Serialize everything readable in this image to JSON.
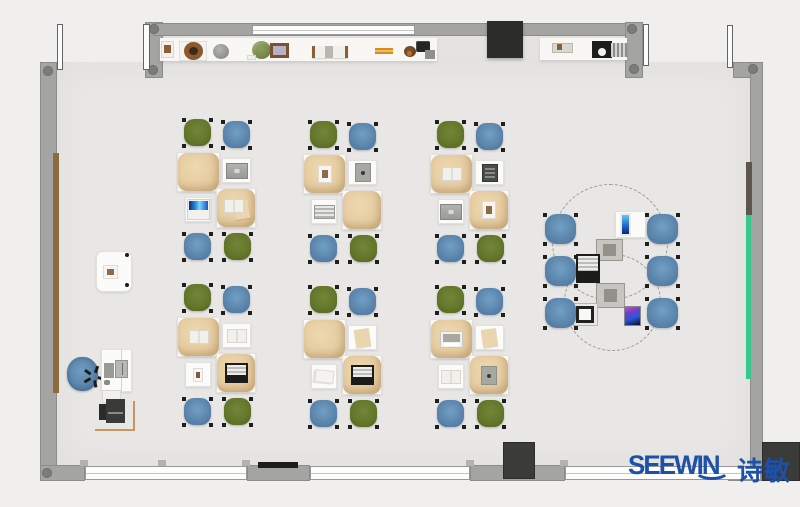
{
  "logo": {
    "brand": "SEEWIN",
    "chinese": "诗敏"
  },
  "palette": {
    "outside": "#f0efee",
    "floor": "#e8e7e5",
    "wall": "#a4a4a2",
    "chair_green": "#64772a",
    "chair_blue": "#5d86ad",
    "cushion_tan": "#e5cba0",
    "desk_white": "#fbfbf9",
    "accent_green_strip": "#36c98b",
    "wood_brown": "#8d6b40",
    "orange_line": "#c8965a",
    "logo_blue": "#1d50a8",
    "tv_black": "#2c2c2a"
  },
  "room": {
    "floor": {
      "x": 56,
      "y": 62,
      "w": 694,
      "h": 404
    },
    "floor_upper": {
      "x": 163,
      "y": 34,
      "w": 474,
      "h": 28
    },
    "walls": [
      {
        "name": "wall-left",
        "x": 40,
        "y": 62,
        "w": 17,
        "h": 405
      },
      {
        "name": "wall-top-stub-left",
        "x": 145,
        "y": 22,
        "w": 18,
        "h": 56
      },
      {
        "name": "wall-top",
        "x": 153,
        "y": 23,
        "w": 484,
        "h": 13
      },
      {
        "name": "wall-top-stub-right",
        "x": 625,
        "y": 22,
        "w": 18,
        "h": 56
      },
      {
        "name": "wall-corner-top-right",
        "x": 733,
        "y": 62,
        "w": 30,
        "h": 16
      },
      {
        "name": "wall-right",
        "x": 750,
        "y": 62,
        "w": 13,
        "h": 405
      },
      {
        "name": "wall-bottom-corner-left",
        "x": 40,
        "y": 465,
        "w": 45,
        "h": 16
      },
      {
        "name": "wall-bottom-seg-1",
        "x": 247,
        "y": 465,
        "w": 63,
        "h": 16
      },
      {
        "name": "wall-bottom-seg-2",
        "x": 470,
        "y": 465,
        "w": 95,
        "h": 16
      },
      {
        "name": "wall-bottom-seg-3",
        "x": 728,
        "y": 466,
        "w": 34,
        "h": 15
      }
    ],
    "corner_dots": [
      {
        "x": 43,
        "y": 66
      },
      {
        "x": 149,
        "y": 24
      },
      {
        "x": 148,
        "y": 65
      },
      {
        "x": 627,
        "y": 24
      },
      {
        "x": 629,
        "y": 64
      },
      {
        "x": 748,
        "y": 64
      },
      {
        "x": 42,
        "y": 468
      }
    ],
    "windows": [
      {
        "name": "window-top",
        "x": 252,
        "y": 25,
        "w": 163,
        "h": 10
      },
      {
        "name": "window-bottom-1",
        "x": 85,
        "y": 466,
        "w": 162,
        "h": 14
      },
      {
        "name": "window-bottom-2",
        "x": 310,
        "y": 466,
        "w": 160,
        "h": 14
      },
      {
        "name": "window-bottom-3",
        "x": 565,
        "y": 466,
        "w": 196,
        "h": 14
      }
    ],
    "window_tabs": [
      {
        "x": 80,
        "y": 460
      },
      {
        "x": 158,
        "y": 460
      },
      {
        "x": 242,
        "y": 460
      },
      {
        "x": 466,
        "y": 460
      },
      {
        "x": 560,
        "y": 460
      }
    ],
    "doors": [
      {
        "name": "door-leaf-top-left-1",
        "x": 57,
        "y": 24,
        "w": 6,
        "h": 46
      },
      {
        "name": "door-leaf-top-left-2",
        "x": 143,
        "y": 24,
        "w": 7,
        "h": 46
      },
      {
        "name": "door-leaf-top-right-1",
        "x": 643,
        "y": 24,
        "w": 6,
        "h": 42
      },
      {
        "name": "door-leaf-top-right-2",
        "x": 727,
        "y": 25,
        "w": 6,
        "h": 43
      }
    ],
    "wall_strips": [
      {
        "name": "wood-panel-left",
        "cls": "it-woodstrip",
        "x": 53,
        "y": 153,
        "w": 6,
        "h": 240
      },
      {
        "name": "dark-panel-right",
        "cls": "it-darkstrip",
        "x": 746,
        "y": 162,
        "w": 6,
        "h": 53
      },
      {
        "name": "green-board-right",
        "cls": "it-greenstrip",
        "x": 746,
        "y": 215,
        "w": 5,
        "h": 164
      }
    ],
    "counters": [
      {
        "name": "top-counter-left",
        "x": 160,
        "y": 38,
        "w": 277,
        "h": 23
      },
      {
        "name": "top-counter-right",
        "x": 540,
        "y": 38,
        "w": 87,
        "h": 22
      }
    ],
    "counter_items": [
      {
        "name": "white-box",
        "cls": "it-whitebox",
        "x": 161,
        "y": 41,
        "w": 13,
        "h": 17
      },
      {
        "name": "brown-ornament",
        "cls": "it-brownbit",
        "x": 164,
        "y": 45,
        "w": 7,
        "h": 8
      },
      {
        "name": "plate",
        "cls": "it-plate",
        "x": 179,
        "y": 41,
        "w": 28,
        "h": 20
      },
      {
        "name": "wreath-bowl",
        "cls": "it-wreath",
        "x": 184,
        "y": 42,
        "w": 19,
        "h": 18
      },
      {
        "name": "gray-sphere",
        "cls": "it-sphere",
        "x": 213,
        "y": 44,
        "w": 16,
        "h": 15
      },
      {
        "name": "plant-pot",
        "cls": "it-plant",
        "x": 252,
        "y": 41,
        "w": 19,
        "h": 18
      },
      {
        "name": "paper-scraps",
        "cls": "it-whitebox",
        "x": 247,
        "y": 55,
        "w": 9,
        "h": 5
      },
      {
        "name": "photo-frame",
        "cls": "it-frame",
        "x": 270,
        "y": 43,
        "w": 19,
        "h": 15
      },
      {
        "name": "bookends-row",
        "cls": "it-bookrow",
        "x": 312,
        "y": 46,
        "w": 36,
        "h": 12
      },
      {
        "name": "orange-sticks",
        "cls": "it-sticks",
        "x": 375,
        "y": 48,
        "w": 18,
        "h": 6
      },
      {
        "name": "brown-round-gadget",
        "cls": "it-brownround",
        "x": 404,
        "y": 46,
        "w": 12,
        "h": 11
      },
      {
        "name": "black-gear-gadget",
        "cls": "it-gear",
        "x": 416,
        "y": 41,
        "w": 14,
        "h": 11
      },
      {
        "name": "gray-gadget",
        "cls": "it-graybit",
        "x": 425,
        "y": 50,
        "w": 10,
        "h": 9
      },
      {
        "name": "orange-dot-gadget",
        "cls": "it-orangedot",
        "x": 407,
        "y": 51,
        "w": 5,
        "h": 5
      },
      {
        "name": "gray-box",
        "cls": "it-graybox",
        "x": 552,
        "y": 43,
        "w": 21,
        "h": 10
      },
      {
        "name": "brown-dot",
        "cls": "it-brownbit",
        "x": 557,
        "y": 44,
        "w": 5,
        "h": 6
      },
      {
        "name": "black-camera",
        "cls": "it-camera",
        "x": 592,
        "y": 41,
        "w": 20,
        "h": 17
      },
      {
        "name": "striped-ramp",
        "cls": "it-ramp",
        "x": 611,
        "y": 43,
        "w": 16,
        "h": 14
      }
    ],
    "fixtures": [
      {
        "name": "tv-panel",
        "cls": "it-tv",
        "x": 487,
        "y": 21,
        "w": 36,
        "h": 37
      },
      {
        "name": "vent-bar",
        "cls": "it-blackbar",
        "x": 258,
        "y": 462,
        "w": 40,
        "h": 6
      },
      {
        "name": "dark-column-bottom-center",
        "cls": "it-darkblock",
        "x": 503,
        "y": 442,
        "w": 32,
        "h": 37
      },
      {
        "name": "dark-column-bottom-right",
        "cls": "it-darkblock",
        "x": 762,
        "y": 442,
        "w": 38,
        "h": 39
      }
    ]
  },
  "furniture": {
    "cluster_template": {
      "chairs": [
        {
          "pos": "tl",
          "dx": 5,
          "dy": 0,
          "w": 31,
          "h": 30,
          "color": "green"
        },
        {
          "pos": "tr",
          "dx": 44,
          "dy": 2,
          "w": 31,
          "h": 30,
          "color": "blue"
        },
        {
          "pos": "bl",
          "dx": 5,
          "dy": 114,
          "w": 31,
          "h": 30,
          "color": "blue"
        },
        {
          "pos": "br",
          "dx": 45,
          "dy": 114,
          "w": 31,
          "h": 30,
          "color": "green"
        }
      ],
      "desks": [
        {
          "pos": "tl",
          "dx": 0,
          "dy": 34,
          "w": 43,
          "h": 40,
          "tan": true
        },
        {
          "pos": "tr",
          "dx": 45,
          "dy": 40,
          "w": 29,
          "h": 25,
          "tan": false
        },
        {
          "pos": "bl",
          "dx": 8,
          "dy": 79,
          "w": 26,
          "h": 25,
          "tan": false
        },
        {
          "pos": "br",
          "dx": 39,
          "dy": 70,
          "w": 40,
          "h": 40,
          "tan": true
        }
      ]
    },
    "clusters": [
      {
        "id": "A",
        "x": 177,
        "y": 118,
        "items": {
          "tl": "none",
          "tr": "laptop-gray",
          "bl": "laptop-blue",
          "br": "book-paper"
        }
      },
      {
        "id": "B",
        "x": 303,
        "y": 120,
        "items": {
          "tl": "paper-pic",
          "tr": "tablet-gray",
          "bl": "book-lined",
          "br": "none"
        }
      },
      {
        "id": "C",
        "x": 430,
        "y": 120,
        "items": {
          "tl": "book-open",
          "tr": "tablet-dark",
          "bl": "laptop-gray",
          "br": "paper-pic"
        }
      },
      {
        "id": "D",
        "x": 177,
        "y": 283,
        "items": {
          "tl": "book-open",
          "tr": "book-open",
          "bl": "pic-brown",
          "br": "laptop-black"
        }
      },
      {
        "id": "E",
        "x": 303,
        "y": 285,
        "items": {
          "tl": "none",
          "tr": "paper-tan",
          "bl": "papers",
          "br": "laptop-black"
        }
      },
      {
        "id": "F",
        "x": 430,
        "y": 285,
        "items": {
          "tl": "monitor-white",
          "tr": "paper-tan",
          "bl": "book-open",
          "br": "tablet-gray"
        }
      }
    ],
    "round_group": {
      "dashed_circles": [
        {
          "x": 552,
          "y": 184,
          "w": 116,
          "h": 116
        },
        {
          "x": 564,
          "y": 254,
          "w": 97,
          "h": 97
        }
      ],
      "chairs": [
        {
          "x": 543,
          "y": 213
        },
        {
          "x": 645,
          "y": 213
        },
        {
          "x": 543,
          "y": 255
        },
        {
          "x": 645,
          "y": 255
        },
        {
          "x": 543,
          "y": 297
        },
        {
          "x": 645,
          "y": 297
        }
      ],
      "chair_size": {
        "w": 35,
        "h": 33
      },
      "devices": [
        {
          "name": "side-table",
          "cls": "desk",
          "x": 615,
          "y": 211,
          "w": 31,
          "h": 27
        },
        {
          "name": "tablet-blue-screen",
          "cls": "it-tablet-blue",
          "x": 620,
          "y": 213,
          "w": 11,
          "h": 23
        },
        {
          "name": "tablet-gray-top",
          "cls": "it-tablet-gray2",
          "x": 596,
          "y": 239,
          "w": 27,
          "h": 22
        },
        {
          "name": "laptop-black",
          "cls": "it-laptop-black",
          "x": 576,
          "y": 254,
          "w": 24,
          "h": 29
        },
        {
          "name": "tablet-gray-bottom",
          "cls": "it-tablet-gray2",
          "x": 596,
          "y": 283,
          "w": 29,
          "h": 25
        },
        {
          "name": "laptop-white",
          "cls": "it-laptop-white",
          "x": 573,
          "y": 303,
          "w": 25,
          "h": 23
        },
        {
          "name": "smartphone",
          "cls": "it-phone",
          "x": 624,
          "y": 306,
          "w": 17,
          "h": 20
        }
      ]
    },
    "teacher_zone": {
      "props": [
        {
          "name": "side-table",
          "kind": "rect",
          "cls": "desk rounded",
          "x": 96,
          "y": 251,
          "w": 36,
          "h": 41
        },
        {
          "name": "side-table-photo",
          "kind": "rect",
          "cls": "itm it-paper-pic",
          "x": 103,
          "y": 265,
          "w": 15,
          "h": 14
        },
        {
          "name": "side-table-leg-1",
          "kind": "rect",
          "cls": "itm it-dotsm",
          "x": 125,
          "y": 253,
          "w": 4,
          "h": 4
        },
        {
          "name": "side-table-leg-2",
          "kind": "rect",
          "cls": "itm it-dotsm",
          "x": 125,
          "y": 283,
          "w": 4,
          "h": 4
        },
        {
          "name": "teacher-chair",
          "kind": "officechair",
          "x": 64,
          "y": 355,
          "w": 37,
          "h": 39
        },
        {
          "name": "teacher-desk",
          "kind": "rect",
          "cls": "desk",
          "x": 101,
          "y": 349,
          "w": 31,
          "h": 43
        },
        {
          "name": "teacher-desk-divider",
          "kind": "rect",
          "cls": "vline",
          "x": 121,
          "y": 350,
          "w": 1,
          "h": 41
        },
        {
          "name": "teacher-monitor",
          "kind": "rect",
          "cls": "itm it-monitor-desk",
          "x": 115,
          "y": 360,
          "w": 13,
          "h": 18
        },
        {
          "name": "teacher-keyboard",
          "kind": "rect",
          "cls": "itm it-keyboard",
          "x": 104,
          "y": 363,
          "w": 10,
          "h": 15
        },
        {
          "name": "teacher-mouse",
          "kind": "rect",
          "cls": "itm it-mouse",
          "x": 104,
          "y": 380,
          "w": 6,
          "h": 5
        },
        {
          "name": "printer-stand",
          "kind": "rect",
          "cls": "itm it-whitebox",
          "x": 102,
          "y": 390,
          "w": 19,
          "h": 13
        },
        {
          "name": "printer",
          "kind": "printer",
          "x": 99,
          "y": 399,
          "w": 26,
          "h": 24
        },
        {
          "name": "orange-line-vertical",
          "kind": "rect",
          "cls": "itm it-orangeline",
          "x": 133,
          "y": 401,
          "w": 2,
          "h": 30
        },
        {
          "name": "orange-line-horizontal",
          "kind": "rect",
          "cls": "itm it-orangeline",
          "x": 95,
          "y": 429,
          "w": 40,
          "h": 2
        }
      ]
    }
  }
}
